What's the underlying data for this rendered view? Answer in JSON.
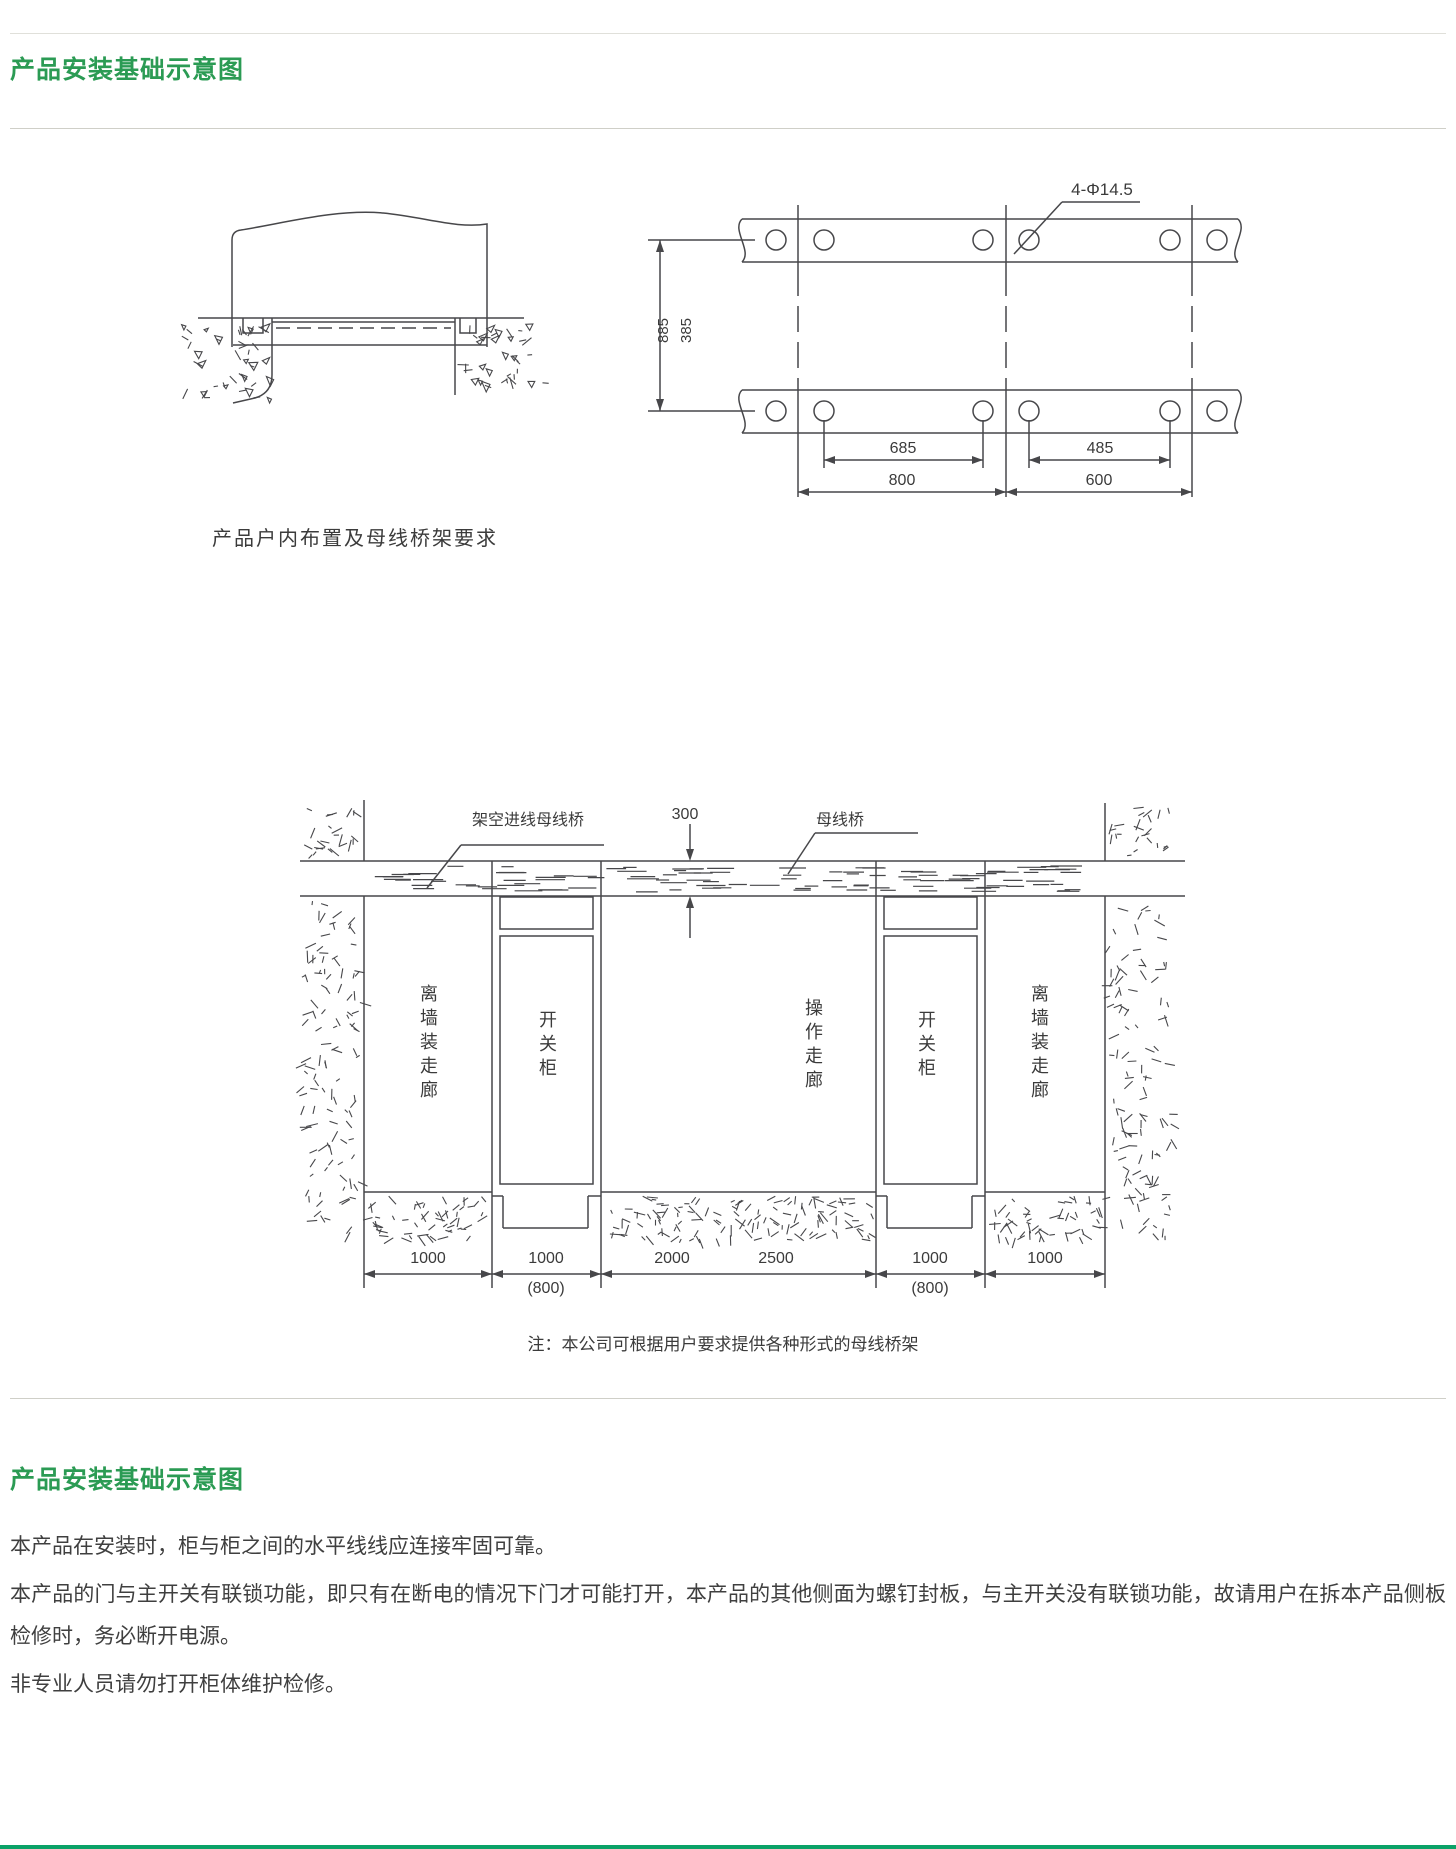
{
  "header": {
    "title": "产品安装基础示意图"
  },
  "fig_indoor": {
    "caption": "产品户内布置及母线桥架要求"
  },
  "fig_base": {
    "hole_note": "4-Φ14.5",
    "v_dims": [
      "885",
      "385"
    ],
    "h_dims_inner": [
      "685",
      "485"
    ],
    "h_dims_outer": [
      "800",
      "600"
    ]
  },
  "fig_room": {
    "overhead_label": "架空进线母线桥",
    "gap_dim": "300",
    "busbar_label": "母线桥",
    "zones": [
      "离墙装走廊",
      "开关柜",
      "操作走廊",
      "开关柜",
      "离墙装走廊"
    ],
    "bottom_dims": [
      "1000",
      "1000",
      "2000",
      "2500",
      "1000",
      "1000"
    ],
    "alt_dims": [
      "(800)",
      "(800)"
    ],
    "note": "注：本公司可根据用户要求提供各种形式的母线桥架"
  },
  "section2": {
    "title": "产品安装基础示意图",
    "paragraphs": [
      "本产品在安装时，柜与柜之间的水平线线应连接牢固可靠。",
      "本产品的门与主开关有联锁功能，即只有在断电的情况下门才可能打开，本产品的其他侧面为螺钉封板，与主开关没有联锁功能，故请用户在拆本产品侧板检修时，务必断开电源。",
      "非专业人员请勿打开柜体维护检修。"
    ]
  }
}
